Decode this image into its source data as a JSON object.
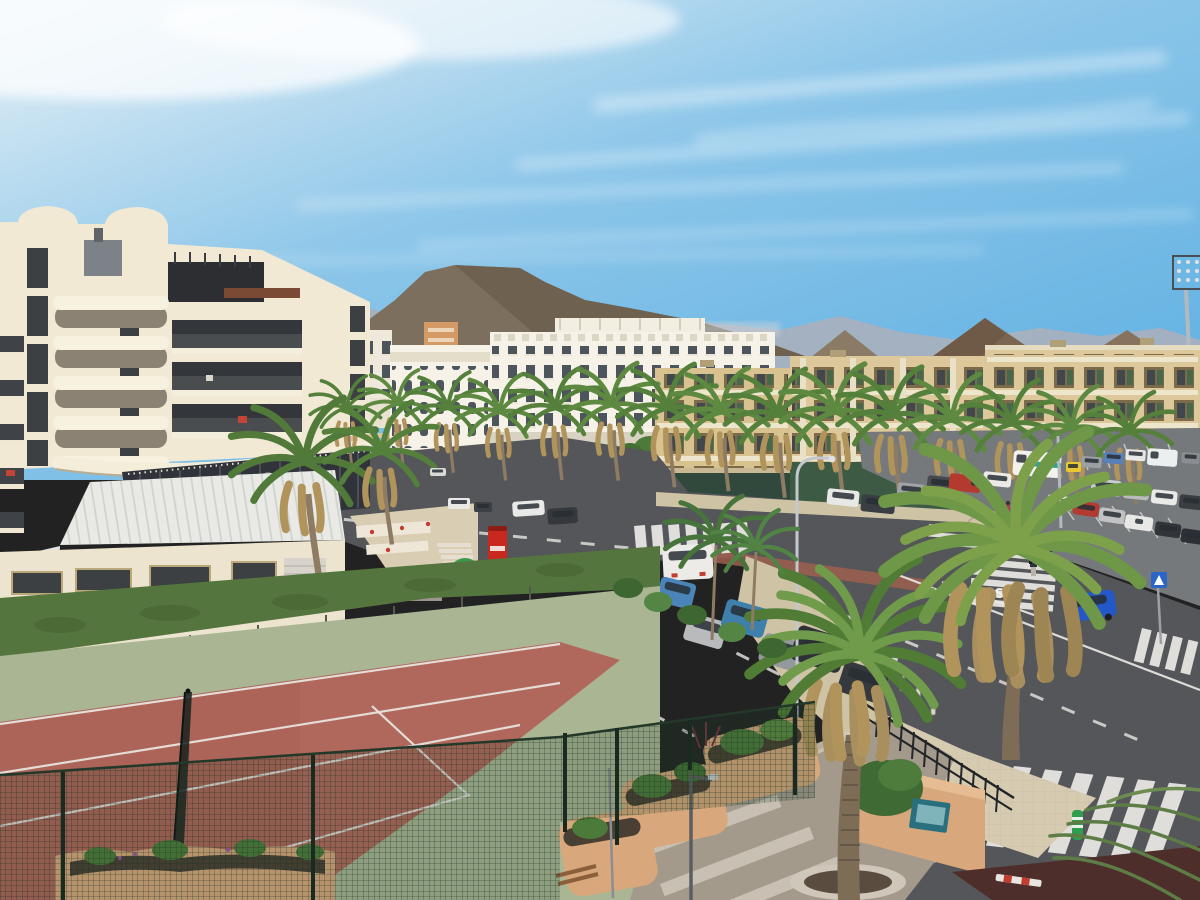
{
  "scene": {
    "type": "photograph",
    "description": "Aerial daytime view of a resort town in the Canary Islands: cream hotel with curved balconies at left, palm-lined avenue with parked cars, white hotels and tan apartment blocks, brown volcanic mountains behind, a road junction with zebra crossings, a full parking lot at right, and a terracotta tennis court behind a green mesh fence in the foreground.",
    "weather": "sunny with wispy cirrus clouds",
    "time_of_day": "day"
  },
  "road": {
    "stop_marking": "STOP"
  },
  "objects": [
    "sky",
    "clouds",
    "mountain-range",
    "volcanic-peaks",
    "stadium-floodlight",
    "distant-city",
    "white-hotel",
    "arched-hotel",
    "orange-building",
    "apartment-blocks",
    "left-hotel",
    "dome-tower",
    "roof-terrace",
    "hotel-balconies",
    "glass-restaurant",
    "annex-roof",
    "annex-building",
    "palm-boulevard",
    "avenue",
    "junction",
    "parking-lot",
    "parked-cars",
    "camper-van",
    "white-van",
    "blue-car",
    "pedestrians",
    "zebra-crossings",
    "stop-marking",
    "street-lamps",
    "crosswalk-sign",
    "vending-machine",
    "recycling-igloo",
    "workers-in-hi-vis",
    "tennis-court",
    "tennis-net",
    "court-apron",
    "hedge-wall",
    "mesh-fence",
    "walkway",
    "planters",
    "big-palm-trees",
    "iron-railing",
    "info-board",
    "bench",
    "green-bollard",
    "barrier",
    "scooters",
    "lawns",
    "sidewalks"
  ],
  "colors": {
    "sky_top": "#e7f1f6",
    "sky_mid": "#8cc6e9",
    "sky_deep": "#5fb0e2",
    "mountain_main": "#7d6f5e",
    "mountain_far": "#a6b0bf",
    "mountain_right": "#7b6551",
    "hotel_cream": "#f1e9d4",
    "white_building": "#f6f2e8",
    "apartment_tan": "#d8c290",
    "road_asphalt": "#54565a",
    "parking_asphalt": "#76797c",
    "road_marking_white": "#ececea",
    "sidewalk_beige": "#cfc3a6",
    "lawn_green": "#6fa043",
    "hedge_green": "#55753f",
    "court_terracotta": "#b0685c",
    "court_apron": "#a9b593",
    "mesh_green": "#1e3a28",
    "walkway_gray": "#a39a8c",
    "planter_terracotta": "#d8a87c",
    "palm_green": "#54803c",
    "palm_dry": "#b1945c",
    "camper_teal": "#2ea39b",
    "wall_maroon": "#4e2e2a"
  }
}
